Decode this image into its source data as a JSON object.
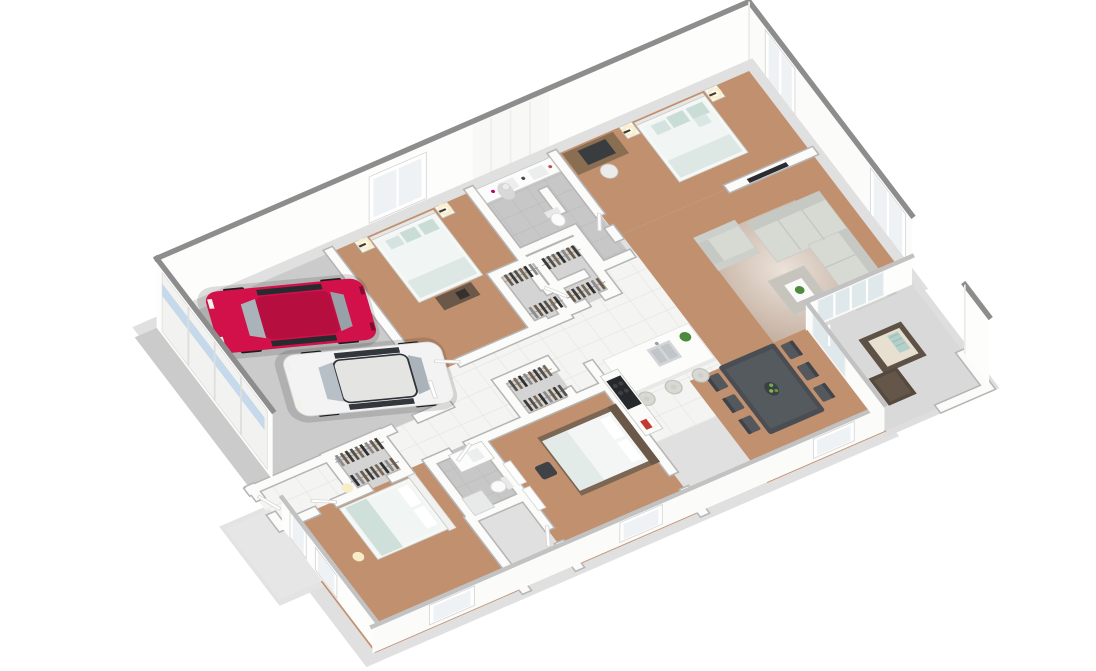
{
  "scene": {
    "description": "Isometric 3D dollhouse floor plan render of a single-story house with attached two-car garage",
    "background": "#ffffff",
    "projection": "axonometric"
  },
  "palette": {
    "wall_white": "#fbfbfa",
    "wall_cap_dark": "#8d8d8d",
    "wall_cap_light": "#c2c2c2",
    "carpet": "#c1906f",
    "tile_white": "#f4f4f2",
    "tile_grout": "#e4e4e2",
    "tile_gray": "#c7c7c7",
    "tile_gray_grout": "#b9b9b9",
    "garage_floor": "#cbcbcb",
    "patio_floor": "#d9d9d9",
    "slab": "#e0e0e0",
    "sofa_fabric": "#d7dad3",
    "sofa_shadow": "#c6c9c3",
    "rug_inner": "#efe9e3",
    "rug_outer": "#c4b2a4",
    "ottoman": "#c7c4bd",
    "bedding_white": "#f5f7f6",
    "pillow_teal": "#c9dcd6",
    "blanket_teal": "#dde8e5",
    "bed3_wood": "#7c6754",
    "dining_table": "#4a4e53",
    "dining_chair": "#54585d",
    "kitchen_island": "#fcfcfb",
    "cooktop": "#26282b",
    "stool": "#d9d9d4",
    "desk_wood": "#8a6e52",
    "glass_door": "#dfe9ec",
    "window_glass": "#eef2f4",
    "garage_door": "#f2f2f1",
    "garage_door_glass": "#c6d9ea",
    "wicker_dark": "#5e5145",
    "wicker_cushion": "#e7dfcf",
    "plant_green": "#4d8a3c",
    "lamp_glow": "#f8edc9",
    "tv_black": "#2c2c2e"
  },
  "rooms": [
    {
      "id": "garage",
      "floor": "concrete",
      "contents": [
        "red-sedan",
        "white-sedan",
        "garage-door-wall",
        "entry-door"
      ]
    },
    {
      "id": "master-bedroom",
      "floor": "carpet",
      "contents": [
        "double-bed",
        "two-nightstands",
        "two-table-lamps",
        "desk",
        "desk-chair",
        "wall-tv",
        "window"
      ]
    },
    {
      "id": "master-bathroom",
      "floor": "gray-tile",
      "contents": [
        "double-vanity",
        "shower-column",
        "toilet",
        "decor-bottles"
      ]
    },
    {
      "id": "living-room",
      "floor": "carpet",
      "contents": [
        "l-shaped-sectional-sofa",
        "armchair",
        "ottoman-coffee-table",
        "rug",
        "plant",
        "corner-windows"
      ]
    },
    {
      "id": "bedroom-2",
      "floor": "carpet",
      "contents": [
        "double-bed",
        "two-nightstands",
        "two-table-lamps",
        "storage-bench",
        "window"
      ]
    },
    {
      "id": "hallway",
      "floor": "white-tile",
      "contents": [
        "walk-in-closet-a",
        "walk-in-closet-b"
      ]
    },
    {
      "id": "kitchen",
      "floor": "white-tile",
      "contents": [
        "island-with-double-sink",
        "three-bar-stools",
        "cooktop-counter",
        "plant",
        "red-decor"
      ]
    },
    {
      "id": "dining-area",
      "floor": "carpet",
      "contents": [
        "dining-table",
        "six-chairs",
        "fruit-bowl",
        "sliding-glass-doors"
      ]
    },
    {
      "id": "bedroom-3",
      "floor": "carpet",
      "contents": [
        "double-bed-wood-frame",
        "desk-chair",
        "walk-in-closet",
        "leaning-mirrors"
      ]
    },
    {
      "id": "bathroom-2",
      "floor": "gray-tile",
      "contents": [
        "vanity",
        "toilet"
      ]
    },
    {
      "id": "bedroom-4",
      "floor": "carpet",
      "contents": [
        "double-bed",
        "walk-in-closet",
        "floor-lamps",
        "porch-door",
        "window"
      ]
    },
    {
      "id": "patio",
      "floor": "concrete",
      "contents": [
        "wicker-armchair",
        "wicker-ottoman",
        "privacy-wall"
      ]
    },
    {
      "id": "porch",
      "floor": "concrete",
      "contents": []
    }
  ],
  "vehicles": [
    {
      "id": "red-sedan",
      "body_color": "#d21049",
      "roof_color": "#b50e3f"
    },
    {
      "id": "white-sedan",
      "body_color": "#f3f3f3",
      "roof_color": "#e4e4e2"
    }
  ],
  "closet_garment_colors": [
    "#3e3a36",
    "#6b5b4a",
    "#8c8c8c",
    "#2f2f2f",
    "#7a6a58",
    "#55504a"
  ]
}
